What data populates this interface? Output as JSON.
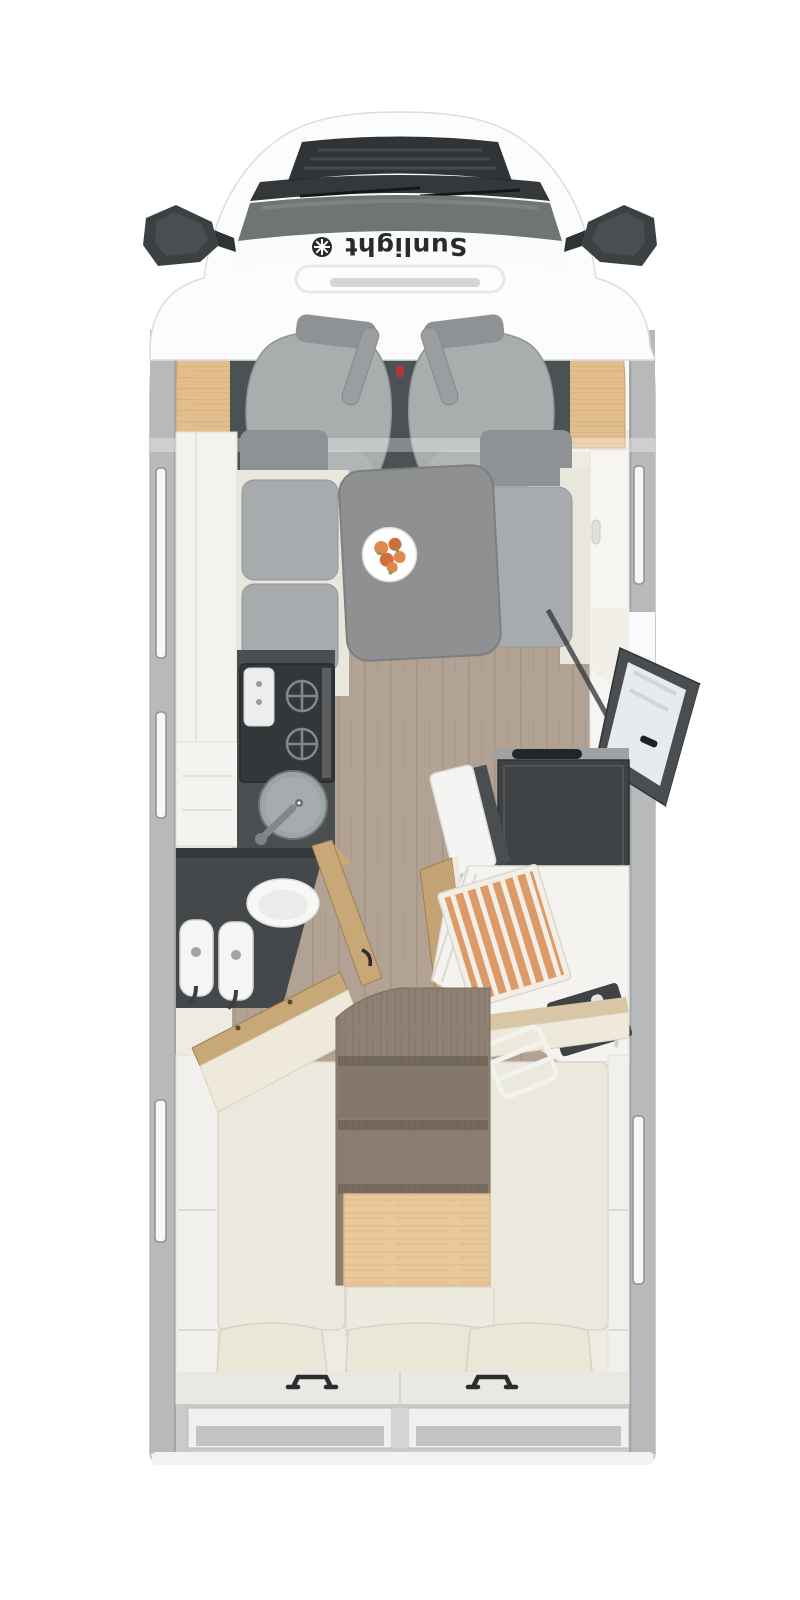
{
  "brand": {
    "name": "Sunlight",
    "logo_icon": "sun-logo-icon",
    "orientation": "rotated-180-on-windshield-cowl"
  },
  "view": "motorhome-top-down-floorplan",
  "colors": {
    "bg": "#ffffff",
    "body": "#fafafa",
    "bodyEdge": "#c9cbcc",
    "wall": "#b7b9bb",
    "wallEdge": "#a3a5a7",
    "windowFrame": "#8f9193",
    "windowGlass": "#f8f8f8",
    "grille": "#2f3438",
    "wiper": "#23272a",
    "windshield": "#6f7671",
    "mirror": "#3b4043",
    "logo": "#2a2a2a",
    "woodTrim": "#e2bd8e",
    "woodTrimLine": "#caa06b",
    "cabFloor": "#4c5154",
    "seat": "#a9adae",
    "seatEdge": "#8f9496",
    "armrest": "#9a9ea0",
    "beltRed": "#b03a3a",
    "creamCab": "#f3f2ec",
    "cushion": "#a8abad",
    "cushionDark": "#8f9294",
    "benchBase": "#e9e6db",
    "table": "#8f9091",
    "tableEdge": "#7d7e80",
    "plate": "#ffffff",
    "fruit": "#df8a4c",
    "fruitDark": "#cf6f3e",
    "leaf": "#7ea15d",
    "floorWood": "#b2a294",
    "floorPlank": "#9c8c7e",
    "interiorBase": "#edebe2",
    "counter": "#4a4e51",
    "stove": "#33373a",
    "grate": "#83888a",
    "sinkSteel": "#9ea3a5",
    "sinkEdge": "#6e7376",
    "white": "#f6f5f2",
    "fridge": "#3e4245",
    "fridgeTop": "#9fa1a3",
    "fridgeHandle": "#232527",
    "doorFrame": "#4a4e51",
    "doorGlass": "#e8ebed",
    "doorWood": "#c9a878",
    "doorWoodEdge": "#a17f50",
    "vanity": "#44484b",
    "porcelain": "#f7f7f5",
    "fixtureDark": "#3f4346",
    "duckOrange": "#db9a67",
    "duckStripe": "#f3efe7",
    "tray": "#f4f3f0",
    "bed": "#ebe8dd",
    "bedEdge": "#d9d6c9",
    "stepWood": "#8e8073",
    "stepShadow": "#5f554b",
    "platformWood": "#e9c89a",
    "platformWoodLine": "#d3ad7c",
    "wardrobe": "#f1f0ec",
    "wardrobeLine": "#dbdad6",
    "shelfOuter": "#c9cacb",
    "shelfInner": "#f0f0ef",
    "shelfShadow": "#c2c3c4",
    "handle": "#2c2c2e",
    "bumper": "#f2f2f1"
  },
  "parts": [
    "cab-roof",
    "front-grille",
    "windshield",
    "wipers",
    "side-mirror-left",
    "side-mirror-right",
    "brand-logo",
    "dashboard-wood-trim",
    "driver-seat",
    "passenger-seat",
    "cab-floor",
    "overhead-cabinet-left",
    "dinette-bench-left",
    "dinette-bench-right",
    "dinette-table",
    "fruit-plate",
    "sideboard-right",
    "kitchen-cabinet",
    "stove",
    "kitchen-sink",
    "entry-door-open",
    "entry-doorway",
    "fridge",
    "fridge-door-open",
    "bathroom-vanity",
    "toilet",
    "twin-washbasins",
    "bathroom-door-open-1",
    "bathroom-door-open-2",
    "bathroom-door-open-3",
    "shower-tray",
    "shower-duckboard",
    "shower-fixture",
    "corridor-wood-floor",
    "rear-steps",
    "bed-left",
    "bed-right",
    "nightstand",
    "pillow-left",
    "pillow-center",
    "pillow-right",
    "bed-ladder",
    "wardrobe-left",
    "wardrobe-right",
    "rear-garage-shelves",
    "grab-handle-left",
    "grab-handle-right",
    "window-left-1",
    "window-left-2",
    "window-left-3",
    "window-right-1",
    "window-right-2",
    "rear-bumper"
  ]
}
